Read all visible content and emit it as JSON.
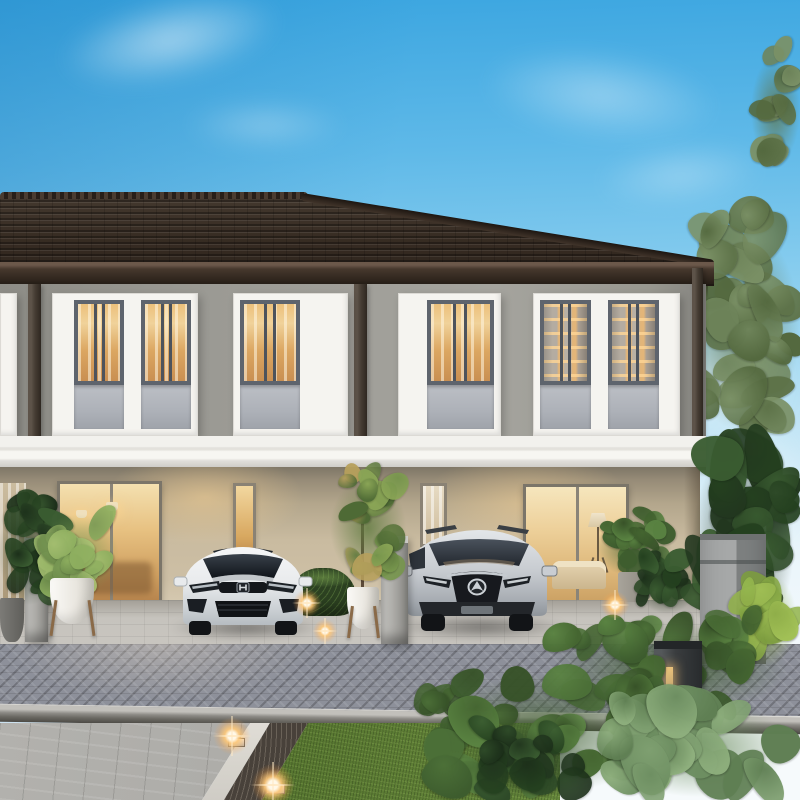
{
  "scene": {
    "description": "Photorealistic dusk rendering of a modern two-storey townhouse row with a dark tiled hip roof, grey upper facade, white trim band and warm-lit interiors; a white Honda hatchback and a silver Mazda SUV are parked in front carports beside a grey paver driveway with tropical landscaping and garden lights.",
    "setting": "residential townhouse development exterior",
    "time_of_day": "dusk",
    "sky": "clear blue sky with thin white clouds"
  },
  "building": {
    "storeys": 2,
    "roof_style": "hipped dark concrete tile",
    "upper_window_count": 4,
    "windows_lit": "warm interior light with curtains and shelving visible",
    "glass_door_count": 2,
    "visible_furnishings": [
      "pendant lamps",
      "tripod floor lamp",
      "sofa",
      "indoor shelves"
    ]
  },
  "vehicles": [
    {
      "label": "white hatchback with Honda emblem",
      "body_color": "#edeff1",
      "position": "left carport"
    },
    {
      "label": "silver SUV with Mazda emblem",
      "body_color": "#c7cbd0",
      "position": "right carport"
    }
  ],
  "landscaping": {
    "potted_plants": 4,
    "planter_colors": [
      "#f1efe9",
      "#9b968d",
      "#6f6e6a"
    ],
    "hedges": "trimmed low hedges beside each carport",
    "lawn_color": "#55742f",
    "garden": "dense tropical foliage along the right side and foreground",
    "lights": [
      "warm ground uplights along planting strip",
      "dark bollard lamp in shrubs"
    ]
  },
  "hardscape": {
    "driveway": "grey herringbone pavers",
    "carport_floor": "light concrete pavers",
    "walkway_edge": "white concrete edging with dark gravel strip",
    "curb": "grey kerb between driveway and lawn"
  },
  "fixtures": {
    "mailbox_pillar": "grey box pillar at right property line",
    "fence_pillars": 2,
    "downpipes": 3
  },
  "colors": {
    "sky_top": "#3aa5e0",
    "sky_low": "#eaf5fb",
    "roof": "#362b22",
    "fascia": "#42352a",
    "wall_upper": "#9b9a94",
    "band": "#f3f2ee",
    "wall_lower": "#cdbfa5",
    "frame": "#f5f4f0",
    "sash": "#5e646d",
    "spandrel": "#adb1b8",
    "glass_warm1": "#f0d29a",
    "glass_warm2": "#c98f52",
    "apron": "#c9c6c0",
    "driveway": "#8d909a",
    "curb": "#8e8c87",
    "sidewalk": "#a7a6a2",
    "gravel": "#48413a",
    "grass": "#55742f",
    "glow": "#ffcf8e",
    "car_white": "#edeff1",
    "car_silver": "#c7cbd0"
  }
}
